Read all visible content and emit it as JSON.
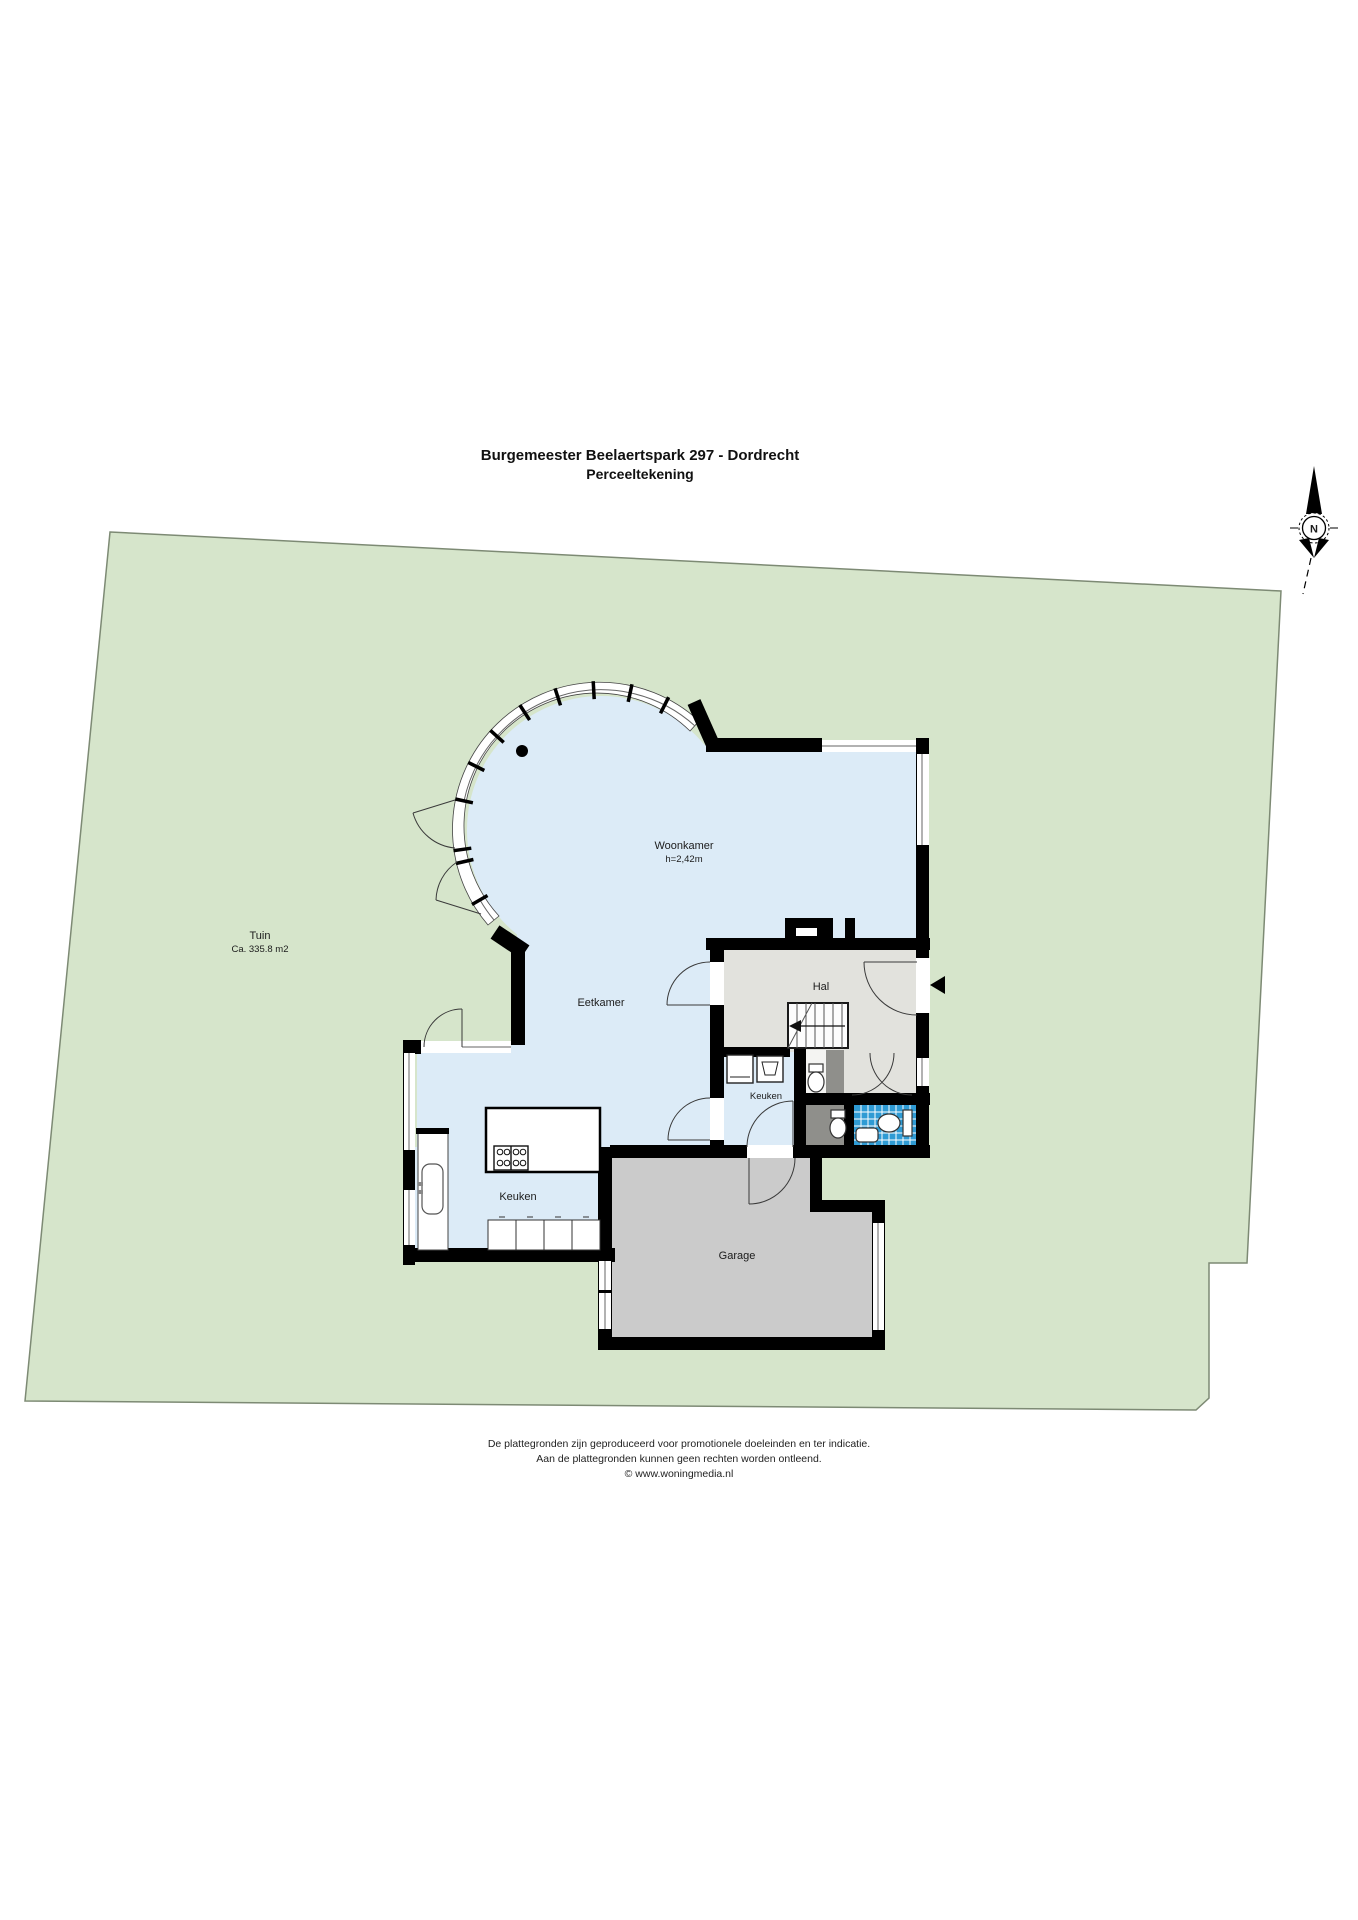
{
  "title": {
    "line1": "Burgemeester Beelaertspark 297 - Dordrecht",
    "line2": "Perceeltekening"
  },
  "compass": {
    "label": "N"
  },
  "rooms": {
    "tuin": {
      "name": "Tuin",
      "area": "Ca. 335.8 m2"
    },
    "woonkamer": {
      "name": "Woonkamer",
      "height": "h=2,42m"
    },
    "eetkamer": {
      "name": "Eetkamer"
    },
    "hal": {
      "name": "Hal"
    },
    "keuken_mid": {
      "name": "Keuken"
    },
    "keuken": {
      "name": "Keuken"
    },
    "garage": {
      "name": "Garage"
    }
  },
  "footer": {
    "line1": "De plattegronden zijn geproduceerd voor promotionele doeleinden en ter indicatie.",
    "line2": "Aan de plattegronden kunnen geen rechten worden ontleend.",
    "line3": "© www.woningmedia.nl"
  },
  "colors": {
    "garden": "#d6e5cb",
    "garden_edge": "#7d8a74",
    "floor": "#dcebf7",
    "hal": "#e2e2dd",
    "garage": "#cbcbcb",
    "closet": "#8f8f8b",
    "tile": "#2f9bd4",
    "wall": "#000000"
  }
}
